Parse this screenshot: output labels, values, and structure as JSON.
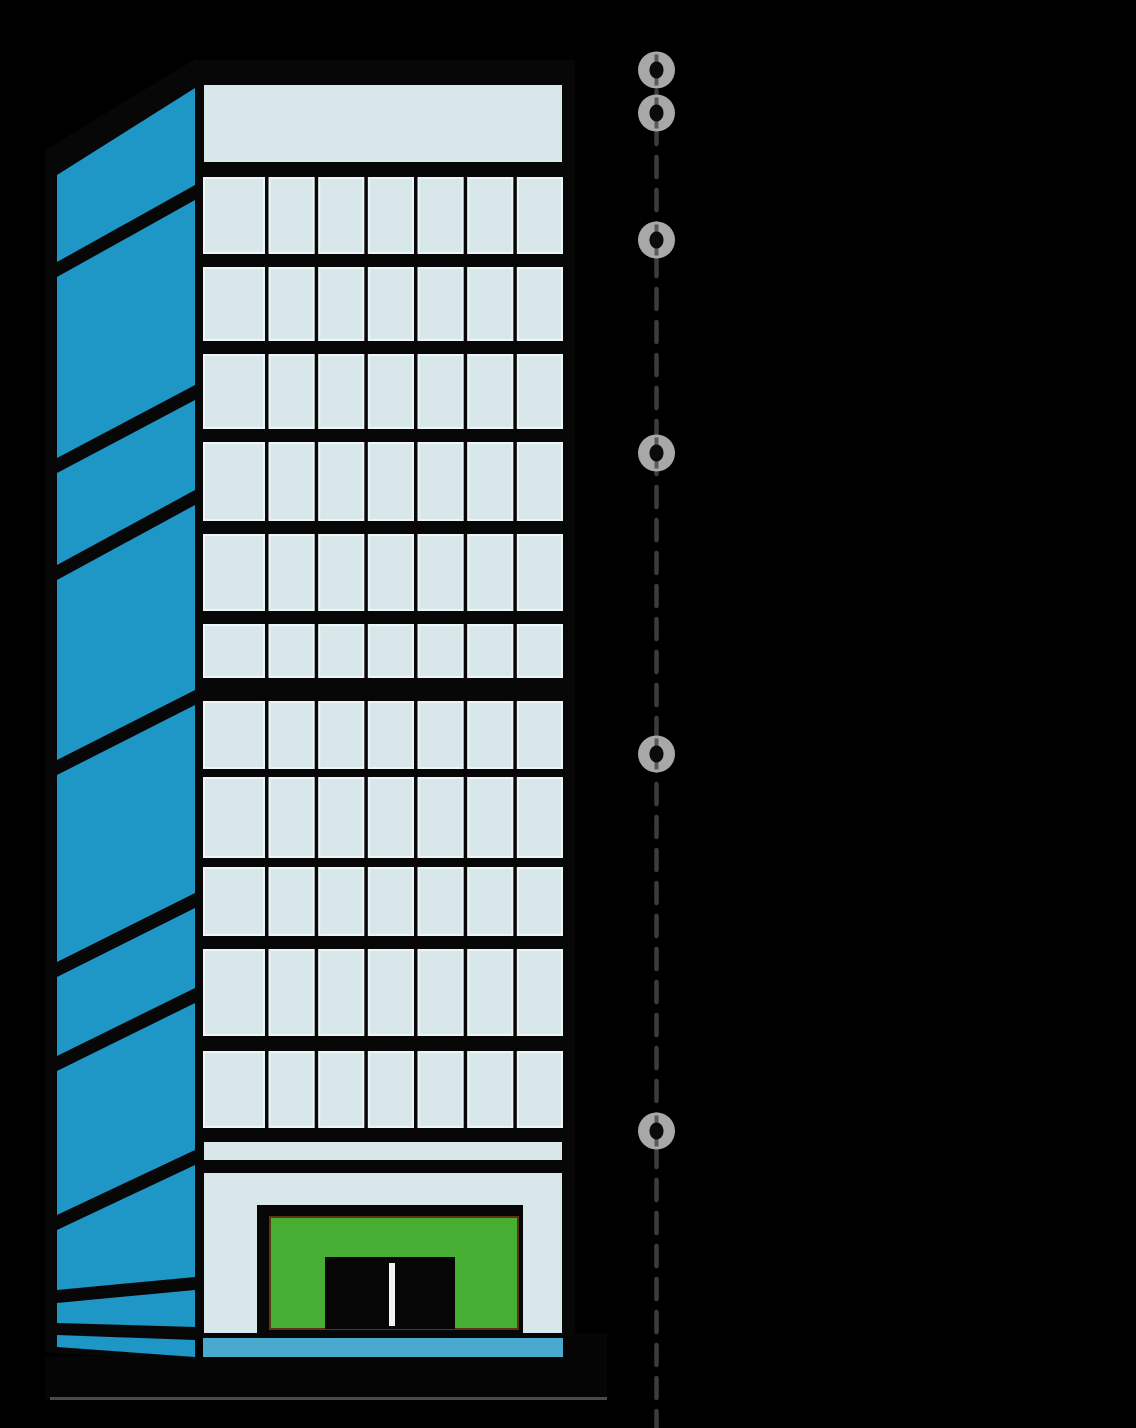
{
  "scene": {
    "width": 1136,
    "height": 1428,
    "background": "#000000",
    "description": "Cartoon skyscraper illustration with vertical dashed guide line and six draggable round markers"
  },
  "colors": {
    "outline_black": "#070707",
    "side_face_blue": "#1e96c6",
    "window_light": "#d8e7ea",
    "window_edge": "#eef5f6",
    "entrance_green": "#45ae33",
    "entrance_green_edge": "#5f3413",
    "door_black": "#060606",
    "door_divider_white": "#f2f2f2",
    "sidewalk_blue": "#49aacd",
    "ground_black": "#050505",
    "ground_bottom_line": "#4a4a4a",
    "dash_gray": "#3c3c3c",
    "node_gray": "#a8a8a8",
    "node_stub_gray": "#5a5a5a",
    "node_dot_black": "#0b0b0b"
  },
  "building": {
    "front": {
      "rect": {
        "x": 195,
        "y": 60,
        "w": 380,
        "h": 1278
      },
      "interior": {
        "x": 204,
        "w": 358
      },
      "top_band": {
        "y": 85,
        "h": 77
      },
      "window_rows": [
        {
          "y": 178,
          "h": 75
        },
        {
          "y": 268,
          "h": 72
        },
        {
          "y": 355,
          "h": 73
        },
        {
          "y": 443,
          "h": 77
        },
        {
          "y": 535,
          "h": 75
        },
        {
          "y": 625,
          "h": 52
        },
        {
          "y": 702,
          "h": 66
        },
        {
          "y": 778,
          "h": 79
        },
        {
          "y": 868,
          "h": 67
        },
        {
          "y": 950,
          "h": 85
        },
        {
          "y": 1052,
          "h": 75
        }
      ],
      "columns": {
        "count": 7,
        "first_w": 60,
        "gap": 5.5
      },
      "mezzanine_band": {
        "y": 1142,
        "h": 18
      },
      "ground_band": {
        "y": 1173,
        "h": 160
      }
    },
    "side": {
      "base_polygon": [
        [
          45,
          150
        ],
        [
          197,
          58
        ],
        [
          197,
          1362
        ],
        [
          45,
          1352
        ]
      ],
      "panel_x": {
        "left": 57,
        "right": 195
      },
      "panels": [
        {
          "lt": 175,
          "rt": 88,
          "lb": 262,
          "rb": 185
        },
        {
          "lt": 277,
          "rt": 200,
          "lb": 458,
          "rb": 385
        },
        {
          "lt": 473,
          "rt": 400,
          "lb": 565,
          "rb": 490
        },
        {
          "lt": 580,
          "rt": 505,
          "lb": 760,
          "rb": 690
        },
        {
          "lt": 775,
          "rt": 705,
          "lb": 962,
          "rb": 893
        },
        {
          "lt": 977,
          "rt": 908,
          "lb": 1056,
          "rb": 988
        },
        {
          "lt": 1071,
          "rt": 1003,
          "lb": 1215,
          "rb": 1150
        },
        {
          "lt": 1230,
          "rt": 1165,
          "lb": 1290,
          "rb": 1277
        },
        {
          "lt": 1303,
          "rt": 1290,
          "lb": 1323,
          "rb": 1327
        },
        {
          "lt": 1335,
          "rt": 1340,
          "lb": 1347,
          "rb": 1357
        }
      ]
    },
    "entrance": {
      "frame": {
        "x": 257,
        "y": 1205,
        "w": 266,
        "h": 133
      },
      "green": {
        "x": 270,
        "y": 1217,
        "w": 248,
        "h": 112
      },
      "door": {
        "x": 325,
        "y": 1257,
        "w": 130,
        "h": 72
      },
      "divider": {
        "x": 389,
        "y": 1263,
        "w": 6,
        "h": 63
      }
    },
    "sidewalk": {
      "x": 203,
      "y": 1338,
      "w": 364,
      "h": 19
    },
    "ground": {
      "bar": {
        "x": 45,
        "y": 1357,
        "w": 562,
        "h": 42
      },
      "step": {
        "x": 563,
        "y": 1333,
        "w": 44,
        "h": 66
      },
      "bottom_line": {
        "x": 50,
        "y": 1397,
        "w": 557,
        "h": 3
      }
    }
  },
  "marker_line": {
    "x": 656.5,
    "y1": 58,
    "y2": 1428,
    "stroke_width": 4.5,
    "dash_pattern": [
      20,
      13
    ],
    "node_radius": 18.5,
    "node_dot_rx": 7,
    "node_dot_ry": 8.5,
    "nodes": [
      {
        "y": 70
      },
      {
        "y": 113
      },
      {
        "y": 240
      },
      {
        "y": 453
      },
      {
        "y": 754
      },
      {
        "y": 1131
      }
    ]
  }
}
